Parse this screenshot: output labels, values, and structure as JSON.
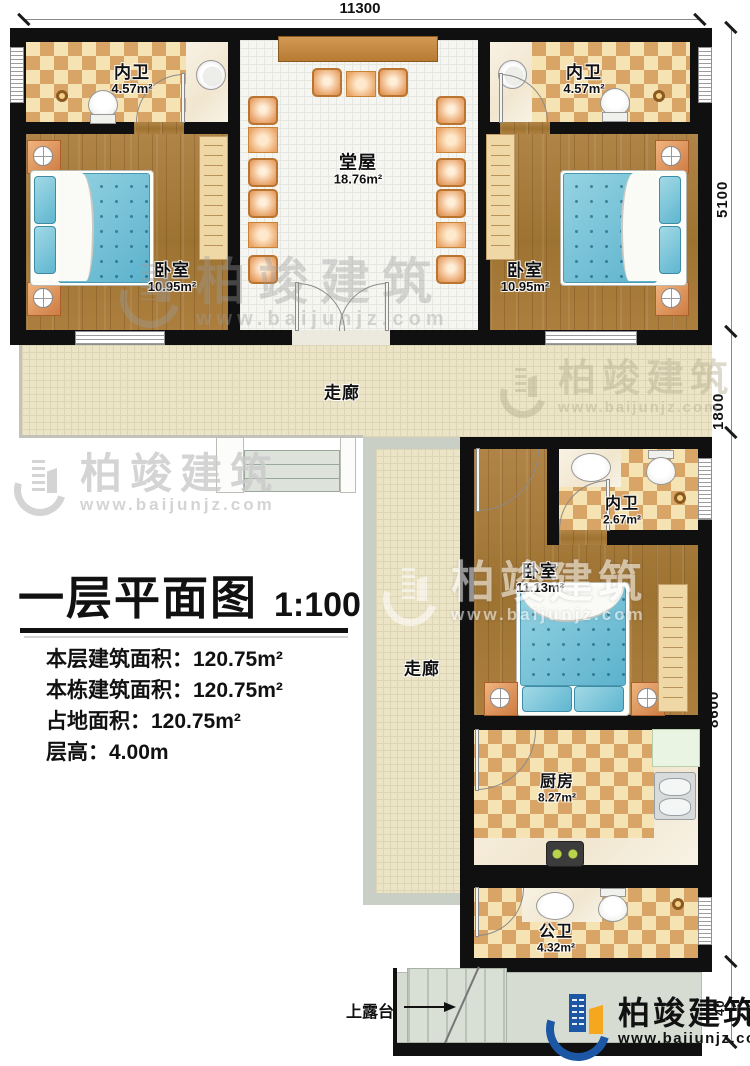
{
  "page": {
    "type": "architectural-floor-plan"
  },
  "title_block": {
    "title": "一层平面图",
    "scale": "1:100",
    "lines": [
      "本层建筑面积：120.75m²",
      "本栋建筑面积：120.75m²",
      "占地面积：120.75m²",
      "层高：4.00m"
    ]
  },
  "dimensions": {
    "top": "11300",
    "right_upper": "5100",
    "right_mid": "1800",
    "right_lower": "8600",
    "right_bottom": "40"
  },
  "rooms": {
    "bath_tl": {
      "name": "内卫",
      "area": "4.57m²"
    },
    "bath_tr": {
      "name": "内卫",
      "area": "4.57m²"
    },
    "hall": {
      "name": "堂屋",
      "area": "18.76m²"
    },
    "bed_tl": {
      "name": "卧室",
      "area": "10.95m²"
    },
    "bed_tr": {
      "name": "卧室",
      "area": "10.95m²"
    },
    "corridor_h": {
      "name": "走廊"
    },
    "corridor_v": {
      "name": "走廊"
    },
    "bath_mid": {
      "name": "内卫",
      "area": "2.67m²"
    },
    "bed_mid": {
      "name": "卧室",
      "area": "11.13m²"
    },
    "kitchen": {
      "name": "厨房",
      "area": "8.27m²"
    },
    "bath_public": {
      "name": "公卫",
      "area": "4.32m²"
    }
  },
  "annotations": {
    "terrace": "上露台"
  },
  "watermark": {
    "name": "柏竣建筑",
    "url": "www.baijunjz.com"
  },
  "branding": {
    "name": "柏竣建筑",
    "url": "www.baijunjz.com"
  },
  "colors": {
    "wall": "#101010",
    "wood_floor": "#a87b3e",
    "tile_light": "#f6e3b4",
    "tile_dark": "#d9a566",
    "bed": "#7cc3da",
    "furniture_orange": "#e8a266",
    "corridor": "#ece4c7",
    "terrace": "#d6dcd2",
    "logo_blue": "#1c57a5",
    "logo_orange": "#f5a81f"
  }
}
